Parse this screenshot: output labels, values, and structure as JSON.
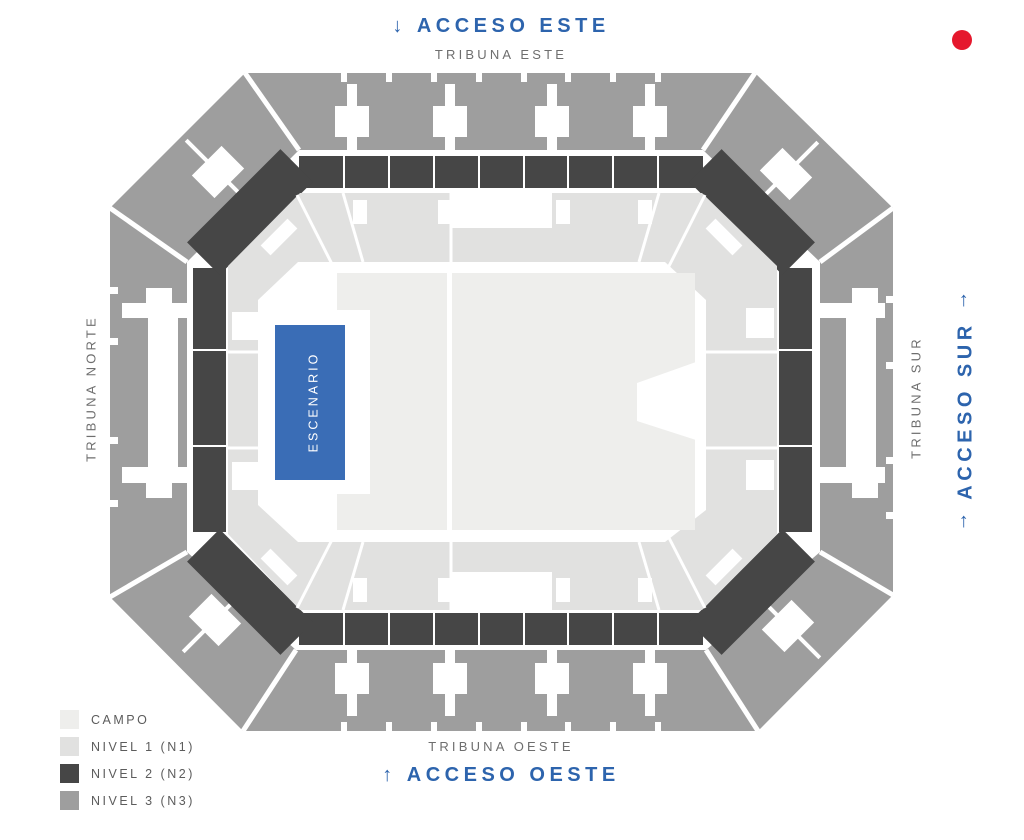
{
  "labels": {
    "acceso_este": {
      "arrow": "↓",
      "text": "ACCESO ESTE"
    },
    "tribuna_este": "TRIBUNA ESTE",
    "tribuna_norte": "TRIBUNA NORTE",
    "tribuna_sur": "TRIBUNA SUR",
    "acceso_sur": {
      "arrow_top": "↑",
      "text": "ACCESO SUR",
      "arrow_bottom": "↑"
    },
    "tribuna_oeste": "TRIBUNA OESTE",
    "acceso_oeste": {
      "arrow": "↑",
      "text": "ACCESO OESTE"
    }
  },
  "stage": {
    "label": "ESCENARIO",
    "color": "#3a6db6"
  },
  "legend": {
    "items": [
      {
        "id": "campo",
        "label": "CAMPO",
        "color": "#eeeeec"
      },
      {
        "id": "nivel1",
        "label": "NIVEL 1 (N1)",
        "color": "#e1e1e0"
      },
      {
        "id": "nivel2",
        "label": "NIVEL 2 (N2)",
        "color": "#464646"
      },
      {
        "id": "nivel3",
        "label": "NIVEL 3 (N3)",
        "color": "#9e9e9e"
      }
    ]
  },
  "indicator": {
    "color": "#e5182d"
  },
  "theme": {
    "access_text_color": "#2d64ad",
    "tribuna_text_color": "#6e6e6e"
  }
}
